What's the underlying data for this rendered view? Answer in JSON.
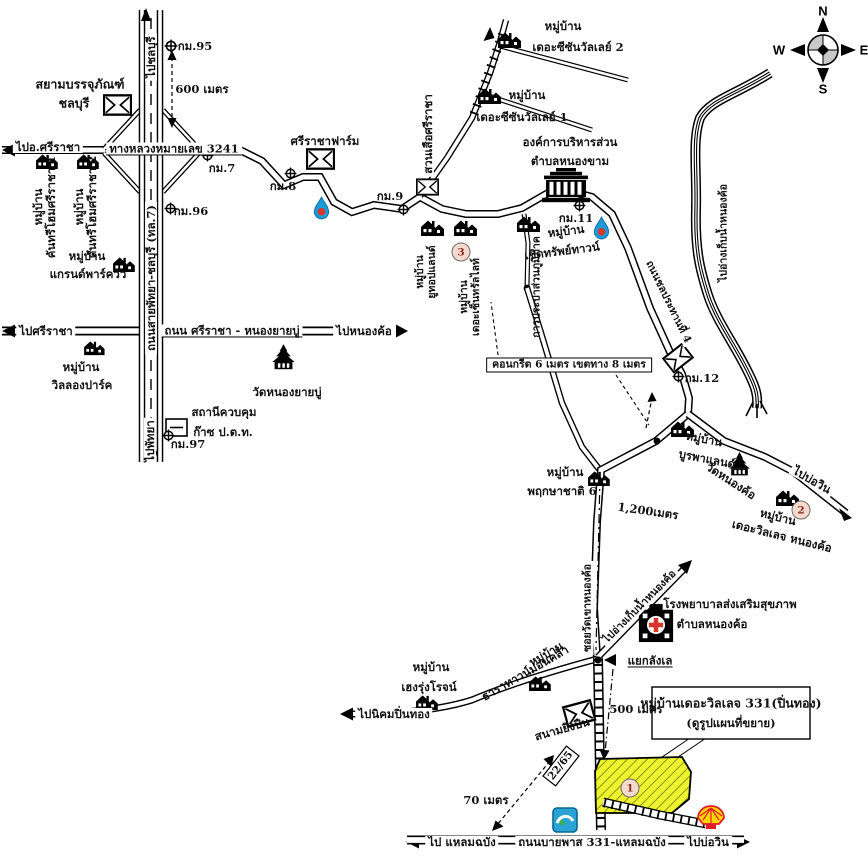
{
  "compass": {
    "n": "N",
    "e": "E",
    "s": "S",
    "w": "W"
  },
  "roads": {
    "motorway": "ถนนสายพัทยา-ชลบุรี (ทล.7)",
    "hwy3241": "ทางหลวงหมายเลข 3241",
    "sriracha_nongyaibu": "ถนน ศรีราชา - หนองยายบู่",
    "chonprathan4": "ถนนชลประทานที่ 4",
    "soi_langle": "ซอยวัดเขาหนองค้อ",
    "bypass331": "ถนนบายพาส 331-แหลมฉบัง",
    "concrete_spec": "คอนกรีต 6 เมตร เขตทาง 8 เมตร"
  },
  "directions": {
    "to_chonburi": "ไปชลบุรี",
    "to_amphoe_sriracha": "ไปอ.ศรีราชา",
    "to_sriracha": "ไปศรีราชา",
    "to_nongkho": "ไปหนองค้อ",
    "to_pattaya": "ไปพัทยา",
    "to_bowin_east": "ไปบ่อวิน",
    "to_reservoir": "ไปอ่างเก็บน้ำหนองค้อ",
    "canal_to_reservoir": "ไปอ่างเก็บน้ำหนองค้อ",
    "to_pinthong": "ไปนิคมปิ่นทอง",
    "to_laemchabang": "ไป แหลมฉบัง",
    "to_bowin_south": "ไปบ่อวิน"
  },
  "km": {
    "k95": "กม.95",
    "k7": "กม.7",
    "k8": "กม.8",
    "k9": "กม.9",
    "k96": "กม.96",
    "k97": "กม.97",
    "k11": "กม.11",
    "k12": "กม.12"
  },
  "dist": {
    "m600": "600 เมตร",
    "m1200": "1,200เมตร",
    "m500": "500 เมตร",
    "m70": "70 เมตร"
  },
  "places": {
    "siam_pack_1": "สยามบรรจุภัณฑ์",
    "siam_pack_2": "ชลบุรี",
    "sriracha_farm": "ศรีราชาฟาร์ม",
    "tiger_zoo": "สวนเสือศรีราชา",
    "obt_1": "องค์การบริหารส่วน",
    "obt_2": "ตำบลหนองขาม",
    "wat_nongyaibu": "วัดหนองยายบู่",
    "gas_station_1": "สถานีควบคุม",
    "gas_station_2": "ก๊าซ ป.ต.ท.",
    "waterworks": "การประปาส่วนภูมิภาค",
    "wat_nongkho": "วัดหนองค้อ",
    "hospital_1": "โรงพยาบาลส่งเสริมสุขภาพ",
    "hospital_2": "ตำบลหนองค้อ",
    "yaek_langle": "แยกลังเล",
    "shooting_range": "สนามยิงปืน",
    "house_no": "22/65"
  },
  "villages": {
    "prefix": "หมู่บ้าน",
    "countryhome1": "คันทรีโฮมศรีราชา 1",
    "countryhome2": "คันทรีโฮมศรีราชา 2",
    "grandparkview": "แกรนด์พาร์ควิว",
    "wilong": "วิลลองปาร์ค",
    "season2": "เดอะซีซันวัลเลย์ 2",
    "season1": "เดอะซีซันวัลเลย์ 1",
    "utop": "ยูทอปแลนด์",
    "centrallight": "เดอะเซ็นทรัลไลท์",
    "cherdsap": "เชิดทรัพย์ทาวน์",
    "burapha": "บูรพาแลนด์",
    "villagenongkho": "เดอะวิลเลจ หนองค้อ",
    "pruksachat": "พฤกษาชาติ 6",
    "hengrung": "เฮงรุ่งโรจน์",
    "tharatown": "ธาราทาวน์ม่อนคล้า"
  },
  "legend": {
    "line1": "หมู่บ้านเดอะวิลเลจ 331(ปิ่นทอง)",
    "line2": "(ดูรูปแผนที่ขยาย)"
  },
  "circled": {
    "n1": "1",
    "n2": "2",
    "n3": "3"
  },
  "colors": {
    "highlight": "#edf32c",
    "ptt_blue": "#1b9cd8",
    "marker_red": "#d9372b",
    "shell_red": "#e21f26",
    "shell_yellow": "#ffd500",
    "logo_blue": "#2aa3d6"
  }
}
